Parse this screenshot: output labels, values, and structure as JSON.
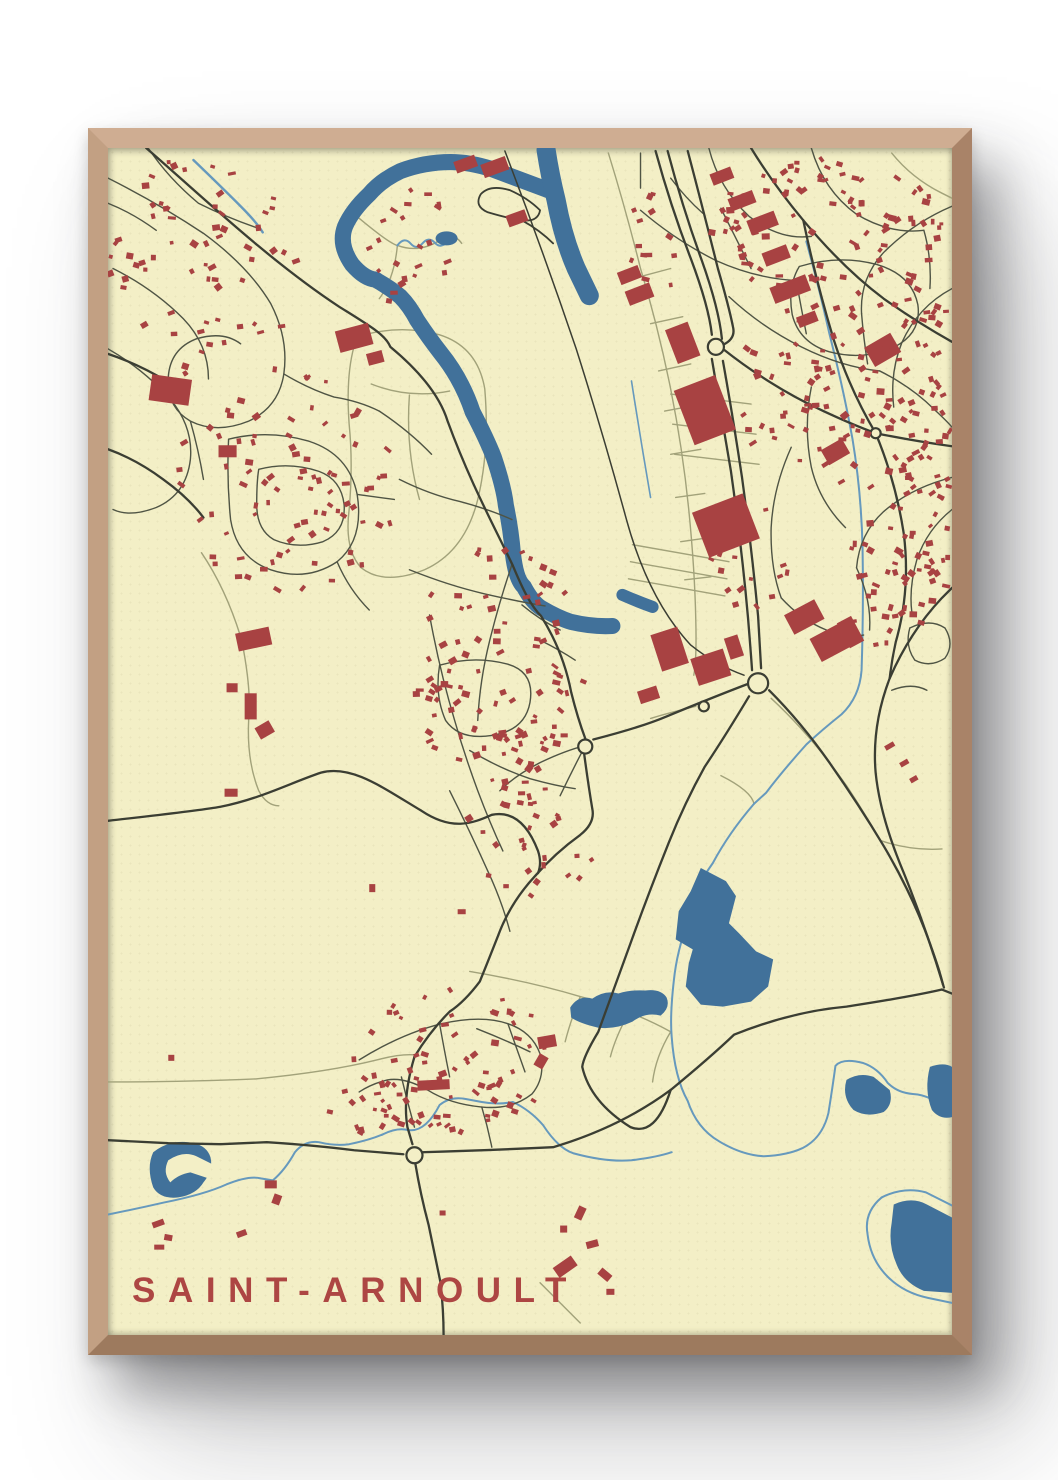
{
  "poster": {
    "title": "SAINT-ARNOULT",
    "title_color": "#ad4643",
    "frame_color": "#c9a183",
    "paper_color": "#f3efc6",
    "background_color": "#ffffff"
  },
  "map": {
    "viewbox": "0 0 840 1182",
    "colors": {
      "paper": "#f3efc6",
      "water": "#41719a",
      "stream": "#6699bd",
      "building": "#a84242",
      "road_major": "#3b3e33",
      "road_mid": "#4f5444",
      "road_minor": "#a2a27a"
    },
    "layers": [
      {
        "name": "field-paths",
        "type": "stroke",
        "color": "road_minor",
        "width": 1.4,
        "items": [
          "M248,188 Q290,175 330,186 Q368,198 375,240 Q380,300 368,350 Q355,402 315,420 Q275,436 252,418 Q235,400 240,360 Q244,315 240,275 Q236,220 248,188",
          "M262,235 Q300,250 340,242 M300,246 Q296,300 310,350",
          "M250,70 Q280,95 288,97 Q310,105 330,92 Q345,84 352,95 M288,97 Q285,130 270,150",
          "M93,403 Q118,440 133,490 Q143,540 140,570 Q138,610 150,640 Q158,655 170,655",
          "M0,930 Q80,930 147,927 Q220,920 268,908 Q290,902 305,903",
          "M498,5 Q515,60 530,120 Q548,180 560,240 Q572,300 578,360 Q584,420 585,470 Q586,510 583,525",
          "M530,128 L560,120 M540,175 L572,168 M548,222 L580,215 M554,262 L586,256 M560,305 L590,300 M565,348 L594,344 M570,392 L598,388 M574,430 L600,427",
          "M522,395 L618,412 M520,412 L616,429 M518,429 L614,446",
          "M560,245 L640,255 M562,275 L645,285 M564,305 L648,315",
          "M660,548 Q700,585 735,635 Q775,695 805,760 Q820,795 828,820",
          "M540,568 Q560,562 585,556",
          "M360,820 Q420,830 470,845 Q520,858 560,880 M470,845 Q460,870 455,890 M520,858 Q505,885 500,905 M560,880 Q545,905 542,930",
          "M430,1130 Q450,1150 470,1170",
          "M780,5 Q800,30 830,45 L840,50",
          "M770,690 Q800,700 830,698",
          "M610,625 Q640,640 643,653"
        ]
      },
      {
        "name": "streams",
        "type": "stroke",
        "color": "stream",
        "width": 2,
        "items": [
          {
            "d": "M85,12 Q112,38 132,58 Q148,74 154,84",
            "w": 2.4
          },
          {
            "d": "M288,97 q7,-9 13,-2 q6,7 12,0 q6,-7 12,-1 q5,6 11,1 l8,-5",
            "w": 2
          },
          {
            "d": "M0,1062 Q30,1056 56,1050 Q96,1042 118,1032 Q140,1023 152,1026 L164,1028 Q176,1018 186,1000 Q196,988 210,990 Q226,994 240,992 Q260,988 274,982 Q288,975 299,978 Q316,980 330,953 Q341,944 356,947 L372,950 Q388,953 403,950 Q420,958 433,973 Q448,996 463,1001 Q496,1010 521,1008 Q546,1005 561,1000",
            "w": 2
          },
          {
            "d": "M643,653 Q618,682 602,712 Q584,737 582,757 Q568,792 564,822 Q559,862 561,885 Q564,926 577,949 Q586,976 608,989 Q631,1003 653,1004 Q676,1003 691,996 Q711,986 717,961 Q721,936 724,914 Q731,906 751,911 Q766,916 776,931 Q786,941 801,942 Q821,943 840,962",
            "w": 2
          },
          {
            "d": "M695,93 Q708,140 718,185 Q732,240 741,290 Q750,345 751,400 Q752,460 750,520 Q748,547 730,564 Q710,580 695,594 Q670,622 655,642 L643,653",
            "w": 2
          },
          {
            "d": "M521,232 Q530,290 540,348",
            "w": 1.6
          },
          {
            "d": "M770,1045 Q752,1060 756,1082 Q759,1107 776,1124 Q792,1140 816,1145 L840,1150",
            "w": 2
          },
          {
            "d": "M770,1045 Q792,1034 814,1040 L840,1053",
            "w": 2
          }
        ]
      },
      {
        "name": "river-bands",
        "type": "stroke",
        "color": "water",
        "cap": "round",
        "items": [
          {
            "d": "M441,43 L382,21 Q360,14 341,14 Q315,14 291,23 Q272,32 260,46 Q243,62 236,78 Q229,96 243,116 Q255,130 266,131 Q282,140 291,148 Q300,157 308,172 Q320,190 331,204 Q352,230 363,263 Q377,290 384,308 Q394,338 396,356 Q401,380 403,404 Q406,430 414,437 Q422,452 431,458 Q448,468 461,472 Q482,477 502,476",
            "w": 16
          },
          {
            "d": "M436,2 Q440,28 446,52 Q453,90 466,120 L479,147",
            "w": 19
          },
          {
            "d": "M512,445 Q528,452 542,457",
            "w": 12
          }
        ]
      },
      {
        "name": "lakes",
        "type": "fill",
        "color": "water",
        "items": [
          "M590,717 L615,730 625,745 618,772 628,782 645,800 662,808 657,835 640,850 612,855 590,853 575,835 578,812 582,798 565,788 568,760 580,740 Z",
          "M460,856 Q468,843 482,847 Q495,838 508,842 Q520,838 535,839 Q550,837 556,846 Q560,856 550,864 Q535,860 522,870 Q505,878 488,876 Q470,872 461,866 Z",
          "M735,928 Q748,920 762,925 L778,938 Q782,952 772,960 Q755,966 742,958 Q730,945 735,928 Z",
          "M818,915 Q832,910 840,915 L840,965 Q828,968 820,958 Q812,938 818,915 Z",
          "M782,1052 Q800,1044 815,1052 L840,1065 L840,1140 L812,1138 Q792,1130 785,1112 Q776,1092 780,1070 Z",
          "M45,1000 Q60,988 80,990 Q98,992 102,1005 Q105,1018 95,1030 Q88,1042 70,1045 Q52,1047 45,1035 Q38,1015 45,1000 Z"
        ]
      },
      {
        "name": "lake-notches",
        "type": "fill",
        "color": "paper",
        "items": [
          "M60,1008 Q75,998 88,1004 L104,1012 L100,1026 L82,1020 Q70,1022 62,1030 Q54,1020 60,1008 Z"
        ]
      },
      {
        "name": "pond",
        "type": "ellipse",
        "color": "water",
        "items": [
          [
            337,
            90,
            11,
            7
          ]
        ]
      },
      {
        "name": "residential-streets",
        "type": "stroke",
        "color": "road_mid",
        "width": 1.4,
        "items": [
          "M0,30 Q50,55 95,85 Q140,118 162,155 Q180,190 175,225 Q170,258 140,272 Q108,285 82,272 Q58,258 60,228 Q62,200 88,190 Q115,182 132,195",
          "M5,120 Q45,140 75,170 Q100,196 100,230",
          "M0,200 Q35,220 62,250 Q85,278 82,310 Q78,345 48,358 Q22,368 5,360",
          "M40,0 Q60,30 90,55 M90,55 Q120,70 150,80",
          "M0,55 Q25,65 48,82",
          "M120,290 Q160,280 200,292 Q240,305 248,345 Q255,390 228,412 Q198,432 162,420 Q128,408 122,370 Q118,330 120,290",
          "M150,320 Q180,312 210,322 Q232,330 235,355 Q237,382 214,392 Q188,400 165,390 Q148,380 148,355 Q148,332 150,320",
          "M175,225 Q200,240 225,248 M225,248 Q250,252 270,262 M82,272 Q90,300 95,330 M248,345 L285,350 M228,412 Q240,440 260,460",
          "M270,262 Q300,282 322,305",
          "M290,330 Q320,345 350,352 Q380,360 402,370",
          "M300,420 Q340,436 375,444 Q410,452 435,456",
          "M330,515 Q365,505 398,514 Q425,522 420,552 Q415,580 382,585 Q350,590 336,570 Q325,545 330,515",
          "M320,465 Q330,520 345,570 Q355,605 368,640 Q380,672 393,700",
          "M402,415 Q390,450 380,490 Q370,530 368,570",
          "M412,455 Q430,470 450,480 M430,490 Q450,500 465,510",
          "M360,600 Q390,618 420,628 Q445,635 465,638",
          "M340,640 Q360,680 378,720 Q392,750 400,780",
          "M475,595 Q455,600 430,612 Q405,625 390,640 M475,595 Q462,620 450,645",
          "M250,908 Q292,882 332,872 Q372,863 398,872 Q422,880 430,902 Q436,925 422,942 Q402,958 372,955 Q340,952 318,938 Q295,925 278,928 Q262,932 250,940",
          "M330,872 Q335,900 340,925 M372,955 Q378,975 382,995 M398,872 Q408,900 415,920 M292,925 Q298,950 305,975",
          "M367,877 Q395,888 420,900",
          "M530,62 Q565,92 605,112 Q645,130 685,132",
          "M598,0 Q608,40 638,68 Q668,92 700,88",
          "M700,0 Q712,42 745,66 Q778,86 812,82",
          "M840,58 Q802,74 772,104 Q748,130 750,165",
          "M688,118 Q728,106 765,116 Q800,126 806,156 Q810,184 783,198 Q752,212 718,203 Q688,194 681,166 Q676,138 688,118",
          "M840,140 Q806,158 790,194 Q778,224 782,258",
          "M618,148 Q650,178 690,198 Q730,218 768,222",
          "M700,238 Q692,278 700,318 Q708,352 734,378",
          "M768,222 Q800,238 822,260 Q835,272 840,278",
          "M840,328 Q800,338 772,362 Q748,384 745,418",
          "M680,298 Q662,338 660,378 Q659,418 670,448",
          "M745,418 Q760,450 758,480",
          "M798,478 Q818,468 833,478 Q843,494 833,508 Q818,518 803,510 Q793,496 798,478",
          "M780,540 Q800,532 815,540",
          "M670,448 Q690,470 715,480 Q735,488 752,485",
          "M610,60 Q625,90 640,120",
          "M685,132 Q690,160 695,185 M750,165 Q752,190 756,215",
          "M812,82 Q820,110 818,140",
          "M840,360 Q815,380 805,410 Q797,438 800,462",
          "M530,5 L530,40 M560,30 Q575,50 592,65"
        ]
      },
      {
        "name": "major-roads",
        "type": "stroke",
        "color": "road_major",
        "width": 2.3,
        "items": [
          "M38,0 C90,45 160,112 230,158 C262,178 276,186 281,198 C310,222 330,246 338,272 C360,332 382,372 403,416 C413,440 421,456 431,466 C446,490 456,516 461,542 C467,566 472,580 475,588",
          "M483,589 Q530,577 556,566 Q602,547 636,534",
          "M474,604 Q478,634 482,658 Q485,672 470,684 Q445,702 425,725 Q400,752 388,785 Q375,818 370,830 Q355,850 340,860 Q320,880 305,905",
          "M305,905 Q293,945 298,975 L303,992",
          "M0,670 C60,663 90,660 112,656 C152,648 182,632 212,622 C242,614 272,636 312,660 C342,680 362,673 382,664 Q412,658 428,700 Q432,712 428,722",
          "M0,988 L60,991 112,992 158,990 Q205,993 245,998 L294,1002",
          "M312,1000 Q380,998 443,995 Q510,975 560,938 Q600,905 623,883 Q680,860 735,855 Q800,845 830,838",
          "M306,1012 Q311,1042 319,1072 L331,1130 Q334,1158 334,1182",
          "M830,838 L840,842",
          "M832,836 Q812,770 788,712 Q768,662 764,622 Q760,575 778,528 Q798,482 830,448 L840,438",
          "M545,3 Q560,58 580,110 Q598,158 601,186",
          "M557,3 Q572,60 591,112 Q608,160 611,190",
          "M601,210 Q610,262 620,322 Q631,400 637,468 Q640,505 641,520",
          "M612,212 Q622,268 631,328 Q641,402 647,466 L650,518",
          "M658,540 Q690,572 718,612 Q748,655 772,695 Q800,742 818,792 Q828,820 831,833",
          {
            "d": "M395,3 Q432,100 466,200 Q492,282 516,370 Q538,450 580,495 Q605,515 633,525",
            "w": 1.5
          },
          "M577,3 Q592,60 607,120 Q618,158 622,178 Q625,190 612,196",
          "M612,200 Q660,238 712,262 Q742,276 764,284",
          "M764,284 Q804,292 840,297",
          "M764,284 Q784,332 792,384 Q799,440 784,492 Q780,510 778,528",
          "M640,0 Q662,36 692,72 Q732,120 772,150 Q806,174 840,193",
          "M692,72 Q704,130 722,190 Q738,240 764,284",
          "M638,546 Q614,586 594,616 Q574,652 558,692 Q538,742 520,792 Q502,842 488,880 Q473,905 472,915 Q480,950 520,975 Q545,985 560,938",
          {
            "d": "M430,62 Q418,50 400,42 Q380,36 371,46 Q364,58 378,64 Q398,70 412,72 Q428,74 430,62 M412,72 Q430,82 443,95",
            "w": 1.8
          },
          "M0,205 Q30,215 58,232",
          "M0,300 Q28,310 55,330 Q80,348 95,368"
        ]
      },
      {
        "name": "roundabouts",
        "type": "circle",
        "fill": "paper",
        "stroke": "road_major",
        "width": 2.2,
        "items": [
          [
            605,
            198,
            8
          ],
          [
            647,
            533,
            10
          ],
          [
            305,
            1003,
            8
          ],
          [
            475,
            596,
            7
          ],
          [
            593,
            556,
            5
          ],
          [
            764,
            284,
            5
          ]
        ]
      },
      {
        "name": "large-buildings",
        "type": "rect",
        "color": "building",
        "items": [
          [
            572,
            232,
            44,
            58,
            -21
          ],
          [
            588,
            352,
            54,
            48,
            -21
          ],
          [
            560,
            176,
            24,
            36,
            -21
          ],
          [
            516,
            138,
            26,
            15,
            -21
          ],
          [
            508,
            120,
            22,
            13,
            -21
          ],
          [
            618,
            46,
            26,
            13,
            -21
          ],
          [
            637,
            67,
            29,
            15,
            -21
          ],
          [
            600,
            22,
            22,
            12,
            -21
          ],
          [
            652,
            100,
            26,
            14,
            -21
          ],
          [
            660,
            132,
            38,
            17,
            -21
          ],
          [
            686,
            165,
            20,
            11,
            -21
          ],
          [
            397,
            64,
            20,
            12,
            -20
          ],
          [
            345,
            10,
            22,
            12,
            -20
          ],
          [
            372,
            12,
            26,
            14,
            -20
          ],
          [
            676,
            456,
            34,
            22,
            -28
          ],
          [
            702,
            478,
            40,
            26,
            -28
          ],
          [
            731,
            468,
            16,
            28,
            -28
          ],
          [
            756,
            190,
            30,
            22,
            -30
          ],
          [
            712,
            294,
            24,
            17,
            -30
          ],
          [
            42,
            228,
            40,
            26,
            8
          ],
          [
            110,
            296,
            18,
            12,
            0
          ],
          [
            228,
            178,
            34,
            22,
            -15
          ],
          [
            258,
            203,
            16,
            12,
            -15
          ],
          [
            545,
            480,
            28,
            38,
            -18
          ],
          [
            583,
            503,
            34,
            28,
            -18
          ],
          [
            616,
            486,
            14,
            22,
            -18
          ],
          [
            528,
            538,
            20,
            13,
            -18
          ],
          [
            128,
            480,
            34,
            18,
            -12
          ],
          [
            136,
            543,
            12,
            26,
            0
          ],
          [
            148,
            573,
            16,
            13,
            -30
          ],
          [
            118,
            533,
            11,
            9,
            0
          ],
          [
            116,
            638,
            13,
            8,
            0
          ],
          [
            428,
            884,
            18,
            12,
            -10
          ],
          [
            426,
            903,
            10,
            13,
            30
          ],
          [
            308,
            928,
            32,
            10,
            -3
          ],
          [
            156,
            1028,
            12,
            8,
            0
          ],
          [
            164,
            1042,
            8,
            10,
            20
          ],
          [
            466,
            1054,
            8,
            13,
            25
          ],
          [
            476,
            1088,
            12,
            7,
            -15
          ],
          [
            488,
            1118,
            13,
            8,
            40
          ],
          [
            450,
            1073,
            7,
            7,
            0
          ],
          [
            444,
            1108,
            22,
            12,
            -35
          ],
          [
            773,
            593,
            10,
            5,
            -30
          ],
          [
            788,
            610,
            9,
            5,
            -30
          ],
          [
            798,
            626,
            8,
            5,
            -30
          ],
          [
            44,
            1068,
            12,
            6,
            -20
          ],
          [
            56,
            1082,
            8,
            6,
            10
          ],
          [
            46,
            1092,
            10,
            5,
            0
          ],
          [
            128,
            1078,
            10,
            6,
            -20
          ],
          [
            260,
            733,
            6,
            8,
            0
          ],
          [
            348,
            758,
            8,
            5,
            0
          ],
          [
            240,
            948,
            6,
            5,
            45
          ],
          [
            330,
            1058,
            6,
            5,
            0
          ],
          [
            60,
            903,
            6,
            6,
            0
          ],
          [
            496,
            1136,
            8,
            6,
            0
          ]
        ]
      },
      {
        "name": "house-clusters",
        "type": "cluster",
        "color": "building",
        "items": [
          {
            "cx": 95,
            "cy": 115,
            "rx": 95,
            "ry": 112,
            "n": 65,
            "seed": 11
          },
          {
            "cx": 180,
            "cy": 330,
            "rx": 110,
            "ry": 115,
            "n": 85,
            "seed": 22
          },
          {
            "cx": 295,
            "cy": 95,
            "rx": 48,
            "ry": 68,
            "n": 22,
            "seed": 33
          },
          {
            "cx": 390,
            "cy": 520,
            "rx": 85,
            "ry": 128,
            "n": 105,
            "seed": 44
          },
          {
            "cx": 420,
            "cy": 690,
            "rx": 68,
            "ry": 58,
            "n": 32,
            "seed": 55
          },
          {
            "cx": 345,
            "cy": 908,
            "rx": 102,
            "ry": 72,
            "n": 75,
            "seed": 66
          },
          {
            "cx": 718,
            "cy": 88,
            "rx": 118,
            "ry": 82,
            "n": 100,
            "seed": 77
          },
          {
            "cx": 790,
            "cy": 255,
            "rx": 95,
            "ry": 105,
            "n": 115,
            "seed": 88
          },
          {
            "cx": 788,
            "cy": 430,
            "rx": 58,
            "ry": 72,
            "n": 42,
            "seed": 99
          },
          {
            "cx": 820,
            "cy": 330,
            "rx": 24,
            "ry": 110,
            "n": 30,
            "seed": 111
          },
          {
            "cx": 668,
            "cy": 240,
            "rx": 38,
            "ry": 85,
            "n": 26,
            "seed": 122
          },
          {
            "cx": 636,
            "cy": 408,
            "rx": 44,
            "ry": 55,
            "n": 16,
            "seed": 133
          },
          {
            "cx": 258,
            "cy": 960,
            "rx": 38,
            "ry": 32,
            "n": 15,
            "seed": 144
          },
          {
            "cx": 540,
            "cy": 100,
            "rx": 30,
            "ry": 55,
            "n": 14,
            "seed": 155
          }
        ]
      }
    ]
  }
}
